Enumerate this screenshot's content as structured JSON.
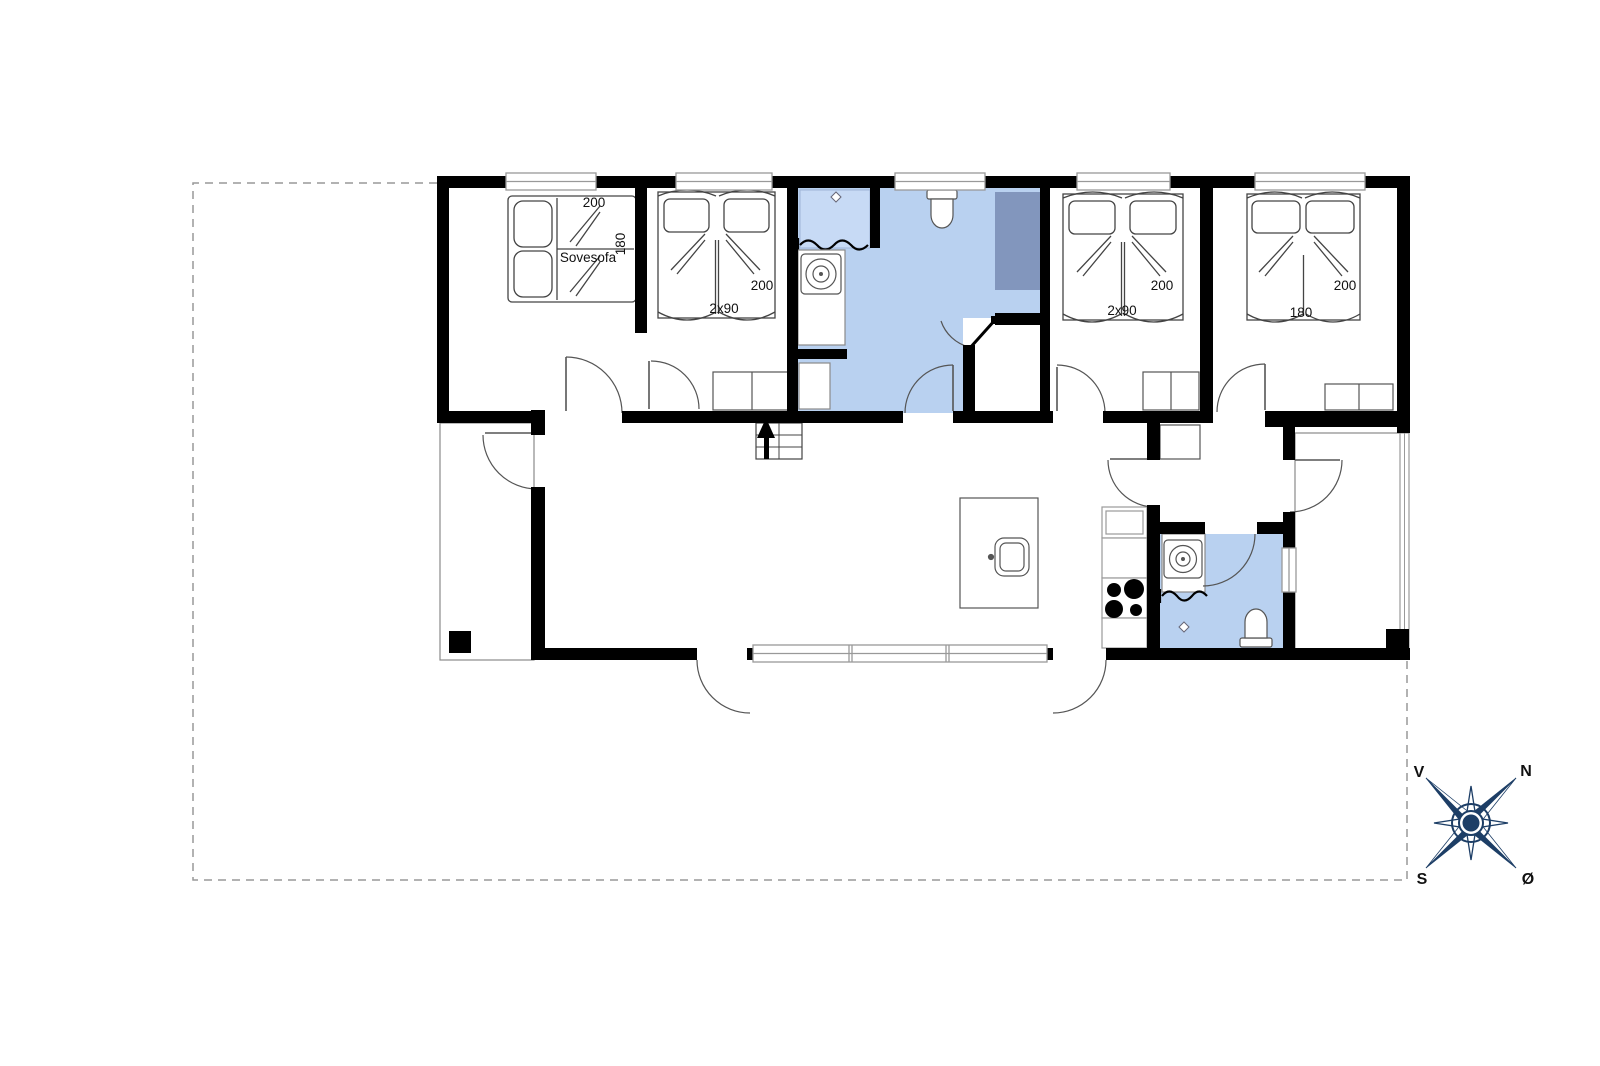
{
  "floor_plan": {
    "rooms": {
      "bedroom_left": {
        "width_label": "200",
        "depth_label": "180",
        "furniture_label": "Sovesofa"
      },
      "bedroom_2": {
        "length_label": "200",
        "beds_label": "2x90"
      },
      "bedroom_3": {
        "length_label": "200",
        "beds_label": "2x90"
      },
      "bedroom_4": {
        "length_label": "200",
        "width_label": "180"
      }
    },
    "compass": {
      "north": "N",
      "west": "V",
      "south": "S",
      "east": "Ø"
    },
    "colors": {
      "wall": "#000000",
      "bath_floor": "#b9d1f0",
      "shower_floor": "#c7daf5",
      "sauna_fill": "#8296bd",
      "compass_navy": "#1d3e66",
      "outline_gray": "#8a8a8a"
    }
  }
}
